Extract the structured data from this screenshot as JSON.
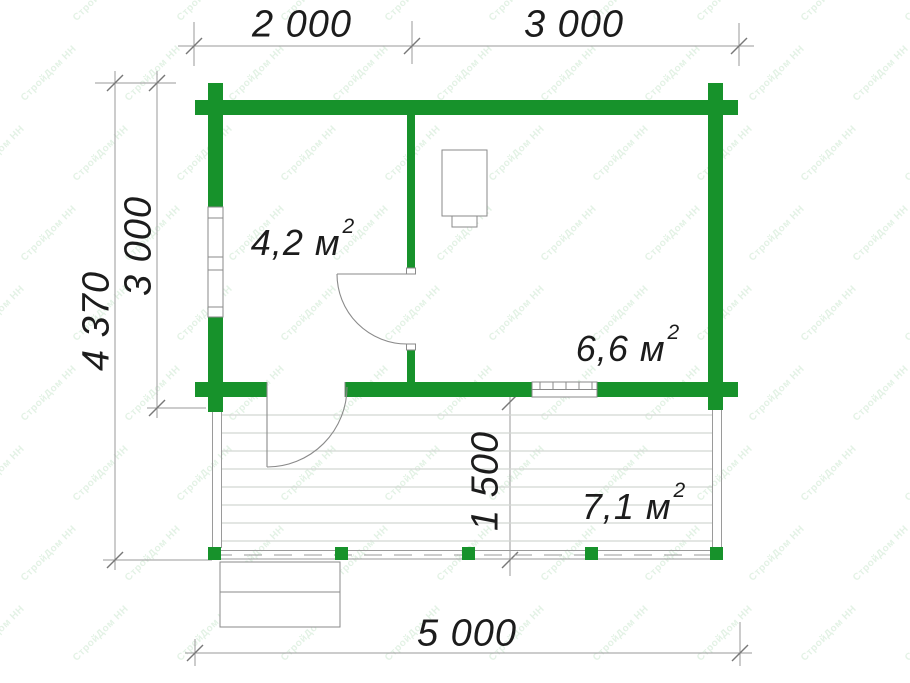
{
  "title": "log-cabin-floor-plan",
  "colors": {
    "wall_green": "#17922b",
    "line_gray": "#9a9a9a",
    "tick_gray": "#787878",
    "deck_gray": "#d2d6d2",
    "outline_gray": "#8a8a8a",
    "text_black": "#1c1c1c",
    "watermark": "rgba(23,146,43,0.12)"
  },
  "dimensions": {
    "top_left": "2 000",
    "top_right": "3 000",
    "left_outer": "4 370",
    "left_inner": "3 000",
    "terrace_depth": "1 500",
    "bottom": "5 000"
  },
  "rooms": [
    {
      "id": "room-left",
      "area": "4,2 м",
      "sup": "2"
    },
    {
      "id": "room-right",
      "area": "6,6 м",
      "sup": "2"
    },
    {
      "id": "terrace",
      "area": "7,1 м",
      "sup": "2"
    }
  ],
  "watermark": {
    "text": "СтройДом НН"
  }
}
